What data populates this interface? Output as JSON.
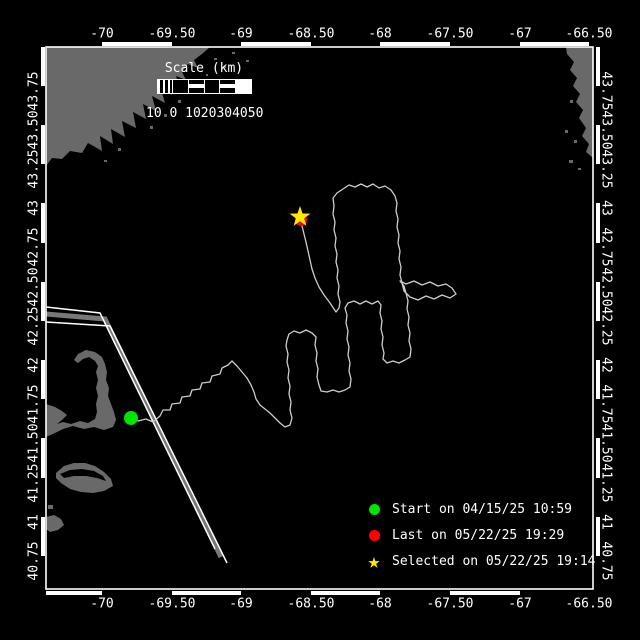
{
  "colors": {
    "background": "#000000",
    "land": "#696969",
    "frame": "#ffffff",
    "text": "#ffffff",
    "track": "#cccccc",
    "lane_edge": "#ffffff",
    "lane_center": "#787878",
    "start_marker": "#00e400",
    "last_marker": "#ff0000",
    "selected_marker": "#ffe800"
  },
  "axes": {
    "lon_labels": [
      "-70",
      "-69.50",
      "-69",
      "-68.50",
      "-68",
      "-67.50",
      "-67",
      "-66.50"
    ],
    "lon_x": [
      102,
      172,
      241,
      311,
      380,
      450,
      520,
      589
    ],
    "top_y": 34,
    "bottom_y": 604,
    "lat_labels": [
      "43.75",
      "43.50",
      "43.25",
      "43",
      "42.75",
      "42.50",
      "42.25",
      "42",
      "41.75",
      "41.50",
      "41.25",
      "41",
      "40.75"
    ],
    "lat_y": [
      91,
      130,
      169,
      208,
      247,
      287,
      326,
      365,
      404,
      443,
      483,
      522,
      561
    ],
    "left_x": 34,
    "right_x": 606
  },
  "scale_bar": {
    "title": "Scale (km)",
    "ticks_text": "10 0 1020304050"
  },
  "legend": {
    "items": [
      {
        "marker": "circle",
        "color": "#00e400",
        "label": "Start on 04/15/25 10:59"
      },
      {
        "marker": "circle",
        "color": "#ff0000",
        "label": "Last on 05/22/25 19:29"
      },
      {
        "marker": "star",
        "color": "#ffe800",
        "label": "Selected on 05/22/25 19:14"
      }
    ]
  },
  "map_data": {
    "frame": {
      "x": 46,
      "y": 47,
      "w": 547,
      "h": 542
    },
    "zebra": {
      "top": {
        "y": 42,
        "h": 4,
        "white_segments": [
          [
            102,
            172
          ],
          [
            241,
            311
          ],
          [
            380,
            450
          ],
          [
            520,
            589
          ]
        ]
      },
      "bottom": {
        "y": 591,
        "h": 4,
        "white_segments": [
          [
            46,
            102
          ],
          [
            172,
            241
          ],
          [
            311,
            380
          ],
          [
            450,
            520
          ]
        ]
      },
      "left": {
        "x": 41,
        "w": 4,
        "white_segments": [
          [
            47,
            86
          ],
          [
            125,
            164
          ],
          [
            203,
            243
          ],
          [
            282,
            321
          ],
          [
            360,
            399
          ],
          [
            438,
            478
          ],
          [
            517,
            556
          ]
        ]
      },
      "right": {
        "x": 596,
        "w": 4,
        "white_segments": [
          [
            47,
            86
          ],
          [
            125,
            164
          ],
          [
            203,
            243
          ],
          [
            282,
            321
          ],
          [
            360,
            399
          ],
          [
            438,
            478
          ],
          [
            517,
            556
          ]
        ]
      }
    },
    "land_polygons": [
      [
        [
          46,
          47
        ],
        [
          210,
          47
        ],
        [
          202,
          54
        ],
        [
          194,
          60
        ],
        [
          198,
          68
        ],
        [
          188,
          64
        ],
        [
          182,
          72
        ],
        [
          186,
          80
        ],
        [
          176,
          76
        ],
        [
          180,
          88
        ],
        [
          169,
          82
        ],
        [
          172,
          95
        ],
        [
          161,
          89
        ],
        [
          165,
          103
        ],
        [
          152,
          96
        ],
        [
          156,
          111
        ],
        [
          143,
          104
        ],
        [
          146,
          119
        ],
        [
          133,
          112
        ],
        [
          136,
          128
        ],
        [
          122,
          121
        ],
        [
          125,
          137
        ],
        [
          111,
          129
        ],
        [
          113,
          144
        ],
        [
          100,
          136
        ],
        [
          102,
          151
        ],
        [
          88,
          143
        ],
        [
          82,
          153
        ],
        [
          70,
          151
        ],
        [
          62,
          159
        ],
        [
          52,
          158
        ],
        [
          46,
          166
        ]
      ],
      [
        [
          566,
          47
        ],
        [
          593,
          47
        ],
        [
          593,
          158
        ],
        [
          586,
          152
        ],
        [
          589,
          144
        ],
        [
          582,
          136
        ],
        [
          586,
          128
        ],
        [
          579,
          118
        ],
        [
          583,
          110
        ],
        [
          576,
          102
        ],
        [
          580,
          94
        ],
        [
          573,
          86
        ],
        [
          577,
          78
        ],
        [
          570,
          70
        ],
        [
          574,
          62
        ],
        [
          567,
          54
        ]
      ],
      [
        [
          46,
          404
        ],
        [
          55,
          407
        ],
        [
          62,
          411
        ],
        [
          67,
          415
        ],
        [
          62,
          420
        ],
        [
          57,
          424
        ],
        [
          63,
          422
        ],
        [
          71,
          424
        ],
        [
          80,
          421
        ],
        [
          88,
          423
        ],
        [
          95,
          419
        ],
        [
          97,
          412
        ],
        [
          96,
          404
        ],
        [
          98,
          396
        ],
        [
          96,
          388
        ],
        [
          98,
          380
        ],
        [
          96,
          372
        ],
        [
          98,
          366
        ],
        [
          95,
          361
        ],
        [
          89,
          357
        ],
        [
          83,
          359
        ],
        [
          78,
          363
        ],
        [
          74,
          360
        ],
        [
          78,
          354
        ],
        [
          86,
          350
        ],
        [
          95,
          352
        ],
        [
          102,
          357
        ],
        [
          105,
          364
        ],
        [
          107,
          372
        ],
        [
          106,
          380
        ],
        [
          109,
          388
        ],
        [
          108,
          396
        ],
        [
          111,
          404
        ],
        [
          114,
          412
        ],
        [
          116,
          420
        ],
        [
          113,
          427
        ],
        [
          104,
          430
        ],
        [
          94,
          427
        ],
        [
          84,
          429
        ],
        [
          73,
          426
        ],
        [
          63,
          429
        ],
        [
          55,
          433
        ],
        [
          46,
          437
        ]
      ],
      [
        [
          56,
          473
        ],
        [
          64,
          466
        ],
        [
          74,
          463
        ],
        [
          85,
          463
        ],
        [
          95,
          466
        ],
        [
          104,
          472
        ],
        [
          111,
          479
        ],
        [
          113,
          486
        ],
        [
          104,
          491
        ],
        [
          93,
          493
        ],
        [
          81,
          492
        ],
        [
          70,
          489
        ],
        [
          61,
          483
        ],
        [
          56,
          478
        ]
      ],
      [
        [
          46,
          517
        ],
        [
          54,
          515
        ],
        [
          61,
          519
        ],
        [
          64,
          525
        ],
        [
          58,
          530
        ],
        [
          50,
          532
        ],
        [
          46,
          529
        ]
      ]
    ],
    "water_notches": [
      [
        [
          60,
          474
        ],
        [
          70,
          470
        ],
        [
          82,
          469
        ],
        [
          94,
          471
        ],
        [
          103,
          476
        ],
        [
          106,
          481
        ],
        [
          97,
          478
        ],
        [
          86,
          476
        ],
        [
          74,
          476
        ],
        [
          64,
          478
        ]
      ]
    ],
    "islet_specks": [
      [
        150,
        126,
        3,
        3
      ],
      [
        164,
        114,
        3,
        3
      ],
      [
        178,
        100,
        3,
        3
      ],
      [
        192,
        86,
        3,
        3
      ],
      [
        214,
        58,
        3,
        2
      ],
      [
        223,
        66,
        3,
        2
      ],
      [
        232,
        52,
        3,
        2
      ],
      [
        246,
        60,
        3,
        2
      ],
      [
        118,
        148,
        3,
        3
      ],
      [
        104,
        160,
        3,
        2
      ],
      [
        250,
        88,
        2,
        2
      ],
      [
        206,
        74,
        2,
        2
      ],
      [
        570,
        100,
        3,
        3
      ],
      [
        565,
        130,
        3,
        3
      ],
      [
        574,
        140,
        3,
        3
      ],
      [
        569,
        160,
        4,
        3
      ],
      [
        578,
        168,
        3,
        2
      ],
      [
        48,
        505,
        5,
        4
      ]
    ],
    "shipping_lane": {
      "edge1": [
        [
          46,
          307
        ],
        [
          100,
          313
        ],
        [
          215,
          549
        ]
      ],
      "center": [
        [
          46,
          314
        ],
        [
          105,
          319
        ],
        [
          221,
          557
        ]
      ],
      "edge2": [
        [
          46,
          322
        ],
        [
          110,
          326
        ],
        [
          227,
          563
        ]
      ]
    },
    "track": [
      [
        132,
        417
      ],
      [
        138,
        421
      ],
      [
        146,
        419
      ],
      [
        153,
        422
      ],
      [
        160,
        416
      ],
      [
        163,
        410
      ],
      [
        170,
        410
      ],
      [
        172,
        404
      ],
      [
        180,
        403
      ],
      [
        182,
        397
      ],
      [
        190,
        396
      ],
      [
        192,
        390
      ],
      [
        200,
        389
      ],
      [
        202,
        383
      ],
      [
        210,
        382
      ],
      [
        212,
        376
      ],
      [
        220,
        374
      ],
      [
        222,
        368
      ],
      [
        228,
        365
      ],
      [
        232,
        361
      ],
      [
        237,
        366
      ],
      [
        242,
        372
      ],
      [
        247,
        378
      ],
      [
        251,
        385
      ],
      [
        254,
        392
      ],
      [
        256,
        399
      ],
      [
        260,
        405
      ],
      [
        265,
        409
      ],
      [
        270,
        413
      ],
      [
        275,
        418
      ],
      [
        280,
        423
      ],
      [
        285,
        427
      ],
      [
        290,
        425
      ],
      [
        292,
        418
      ],
      [
        290,
        410
      ],
      [
        291,
        402
      ],
      [
        289,
        394
      ],
      [
        290,
        386
      ],
      [
        288,
        378
      ],
      [
        289,
        370
      ],
      [
        287,
        362
      ],
      [
        288,
        354
      ],
      [
        286,
        346
      ],
      [
        287,
        340
      ],
      [
        289,
        334
      ],
      [
        294,
        331
      ],
      [
        300,
        333
      ],
      [
        306,
        330
      ],
      [
        312,
        333
      ],
      [
        316,
        337
      ],
      [
        315,
        345
      ],
      [
        317,
        353
      ],
      [
        316,
        361
      ],
      [
        318,
        369
      ],
      [
        317,
        377
      ],
      [
        319,
        385
      ],
      [
        321,
        391
      ],
      [
        327,
        392
      ],
      [
        333,
        390
      ],
      [
        339,
        392
      ],
      [
        345,
        390
      ],
      [
        350,
        387
      ],
      [
        351,
        379
      ],
      [
        349,
        371
      ],
      [
        350,
        363
      ],
      [
        348,
        355
      ],
      [
        349,
        347
      ],
      [
        347,
        339
      ],
      [
        348,
        331
      ],
      [
        346,
        323
      ],
      [
        347,
        315
      ],
      [
        345,
        308
      ],
      [
        348,
        303
      ],
      [
        354,
        301
      ],
      [
        360,
        304
      ],
      [
        366,
        301
      ],
      [
        372,
        304
      ],
      [
        378,
        301
      ],
      [
        381,
        305
      ],
      [
        380,
        313
      ],
      [
        382,
        321
      ],
      [
        381,
        329
      ],
      [
        383,
        337
      ],
      [
        382,
        345
      ],
      [
        384,
        353
      ],
      [
        383,
        359
      ],
      [
        387,
        363
      ],
      [
        393,
        361
      ],
      [
        399,
        363
      ],
      [
        405,
        360
      ],
      [
        410,
        357
      ],
      [
        411,
        349
      ],
      [
        409,
        341
      ],
      [
        410,
        333
      ],
      [
        408,
        325
      ],
      [
        409,
        317
      ],
      [
        407,
        309
      ],
      [
        408,
        301
      ],
      [
        406,
        293
      ],
      [
        404,
        286
      ],
      [
        400,
        281
      ],
      [
        406,
        284
      ],
      [
        414,
        281
      ],
      [
        422,
        285
      ],
      [
        430,
        282
      ],
      [
        438,
        286
      ],
      [
        446,
        284
      ],
      [
        452,
        288
      ],
      [
        456,
        294
      ],
      [
        450,
        298
      ],
      [
        442,
        295
      ],
      [
        434,
        299
      ],
      [
        426,
        296
      ],
      [
        418,
        300
      ],
      [
        410,
        297
      ],
      [
        404,
        291
      ],
      [
        402,
        283
      ],
      [
        400,
        275
      ],
      [
        401,
        267
      ],
      [
        399,
        259
      ],
      [
        400,
        251
      ],
      [
        398,
        243
      ],
      [
        399,
        235
      ],
      [
        397,
        227
      ],
      [
        398,
        219
      ],
      [
        396,
        211
      ],
      [
        397,
        203
      ],
      [
        395,
        196
      ],
      [
        391,
        190
      ],
      [
        385,
        186
      ],
      [
        379,
        188
      ],
      [
        373,
        184
      ],
      [
        367,
        187
      ],
      [
        361,
        184
      ],
      [
        355,
        187
      ],
      [
        349,
        185
      ],
      [
        343,
        189
      ],
      [
        337,
        193
      ],
      [
        333,
        198
      ],
      [
        334,
        206
      ],
      [
        333,
        214
      ],
      [
        335,
        222
      ],
      [
        334,
        230
      ],
      [
        336,
        238
      ],
      [
        335,
        246
      ],
      [
        337,
        254
      ],
      [
        336,
        262
      ],
      [
        338,
        270
      ],
      [
        337,
        278
      ],
      [
        339,
        286
      ],
      [
        338,
        294
      ],
      [
        340,
        302
      ],
      [
        339,
        308
      ],
      [
        336,
        312
      ],
      [
        330,
        303
      ],
      [
        324,
        295
      ],
      [
        319,
        287
      ],
      [
        315,
        278
      ],
      [
        312,
        269
      ],
      [
        310,
        260
      ],
      [
        308,
        251
      ],
      [
        306,
        242
      ],
      [
        304,
        234
      ],
      [
        302,
        226
      ],
      [
        300,
        218
      ]
    ],
    "markers": {
      "start": {
        "x": 131,
        "y": 418,
        "r": 7
      },
      "last": {
        "x": 301,
        "y": 220,
        "r": 6
      },
      "selected": {
        "x": 300,
        "y": 217,
        "r_outer": 11,
        "r_inner": 4.3
      }
    }
  }
}
